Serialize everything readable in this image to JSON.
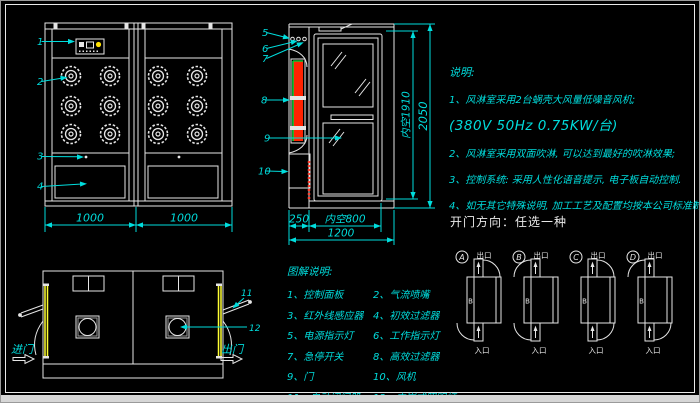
{
  "colors": {
    "background": "#000000",
    "line_white": "#e6e6e6",
    "annotation_cyan": "#00dddd",
    "door_strip_yellow": "#ffff33",
    "filter_red": "#ff2200",
    "filter_green": "#00cc33",
    "indicator_yellow": "#ffe000"
  },
  "front_view": {
    "callouts": [
      "1",
      "2",
      "3",
      "4"
    ],
    "dim_left": "1000",
    "dim_right": "1000"
  },
  "side_view": {
    "callouts": [
      "5",
      "6",
      "7",
      "8",
      "9",
      "10"
    ],
    "dims": {
      "inner_height": "内空1910",
      "total_height": "2050",
      "left_depth": "250",
      "inner_width": "内空800",
      "total_width": "1200"
    }
  },
  "plan_view": {
    "callout_11": "11",
    "callout_12": "12",
    "enter_label": "进门",
    "exit_label": "出门"
  },
  "notes": {
    "title": "说明:",
    "lines": [
      "1、风淋室采用2台蜗壳大风量低噪音风机;",
      "(380V  50Hz  0.75KW/台)",
      "2、风淋室采用双面吹淋, 可以达到最好的吹淋效果;",
      "3、控制系统: 采用人性化语音提示, 电子板自动控制.",
      "4、如无其它特殊说明, 加工工艺及配置均按本公司标准制作."
    ]
  },
  "door_direction": {
    "title": "开门方向：任选一种",
    "exit_label": "出口",
    "enter_label": "入口",
    "inner_label": "B",
    "options": [
      "A",
      "B",
      "C",
      "D"
    ]
  },
  "legend": {
    "title": "图解说明:",
    "items": [
      "1、控制面板",
      "2、气流喷嘴",
      "3、红外线感应器",
      "4、初效过滤器",
      "5、电源指示灯",
      "6、工作指示灯",
      "7、急停开关",
      "8、高效过滤器",
      "9、门",
      "10、风机",
      "11、自动闭门器",
      "12、内嵌式照明灯"
    ]
  }
}
